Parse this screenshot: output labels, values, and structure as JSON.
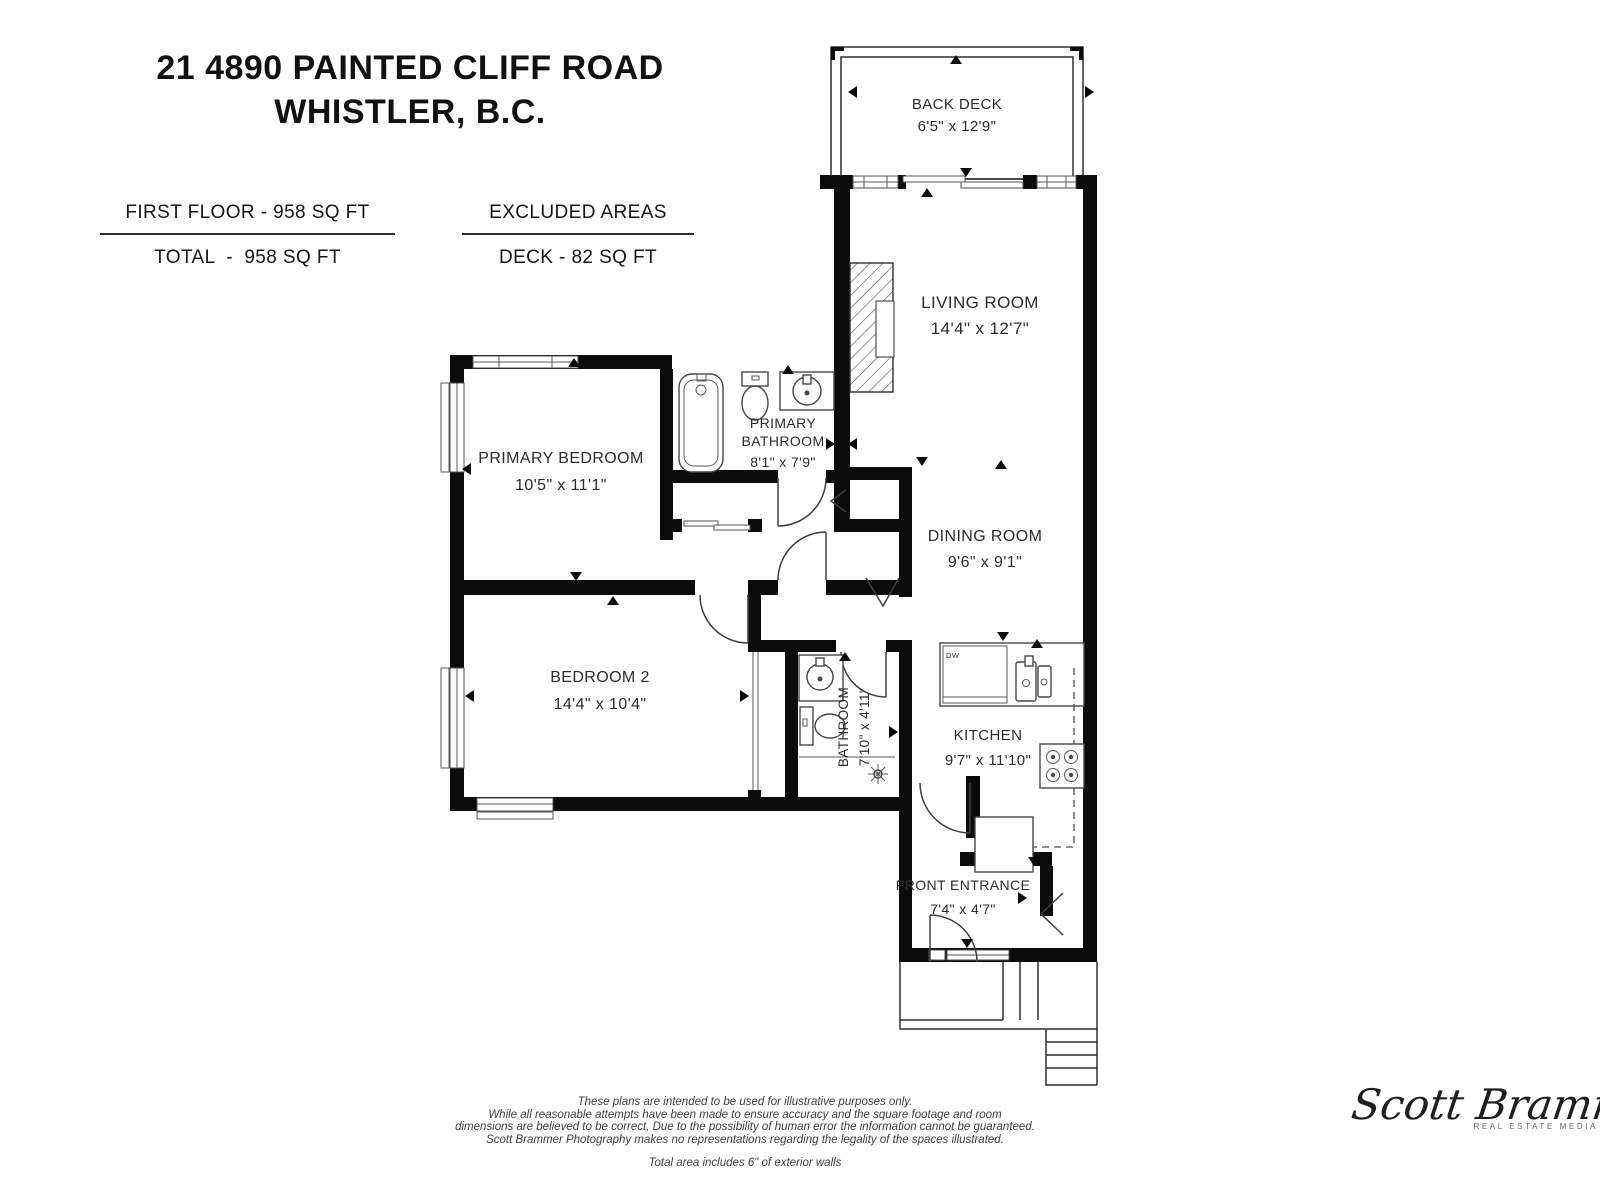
{
  "header": {
    "title_line1": "21 4890 PAINTED CLIFF ROAD",
    "title_line2": "WHISTLER, B.C."
  },
  "stats": {
    "first_floor": "FIRST FLOOR - 958 SQ FT",
    "total": "TOTAL  -  958 SQ FT",
    "excluded_title": "EXCLUDED AREAS",
    "excluded_item": "DECK - 82 SQ FT"
  },
  "rooms": {
    "back_deck": {
      "name": "BACK DECK",
      "dims": "6'5\" x 12'9\""
    },
    "living_room": {
      "name": "LIVING ROOM",
      "dims": "14'4\" x 12'7\""
    },
    "primary_bedroom": {
      "name": "PRIMARY BEDROOM",
      "dims": "10'5\" x 11'1\""
    },
    "primary_bathroom": {
      "name_line1": "PRIMARY",
      "name_line2": "BATHROOM",
      "dims": "8'1\" x 7'9\""
    },
    "dining_room": {
      "name": "DINING ROOM",
      "dims": "9'6\" x 9'1\""
    },
    "bedroom_2": {
      "name": "BEDROOM 2",
      "dims": "14'4\" x 10'4\""
    },
    "bathroom": {
      "name": "BATHROOM",
      "dims": "7'10\" x 4'11\""
    },
    "kitchen": {
      "name": "KITCHEN",
      "dims": "9'7\" x 11'10\""
    },
    "front_entrance": {
      "name": "FRONT ENTRANCE",
      "dims": "7'4\" x 4'7\""
    }
  },
  "fixtures": {
    "dishwasher_label": "DW"
  },
  "footer": {
    "line1": "These plans are intended to be used for illustrative purposes only.",
    "line2": "While all reasonable attempts have been made to ensure accuracy and the square footage and room",
    "line3": "dimensions are believed to be correct,  Due to the possibility of human error the information cannot be guaranteed.",
    "line4": "Scott Brammer Photography makes no representations regarding the legality of the spaces illustrated.",
    "note": "Total area includes 6\" of exterior walls"
  },
  "logo": {
    "script": "Scott Brammer",
    "tagline": "REAL ESTATE MEDIA"
  },
  "colors": {
    "wall": "#0b0b0b",
    "line": "#474747",
    "text": "#2c2c2c"
  }
}
